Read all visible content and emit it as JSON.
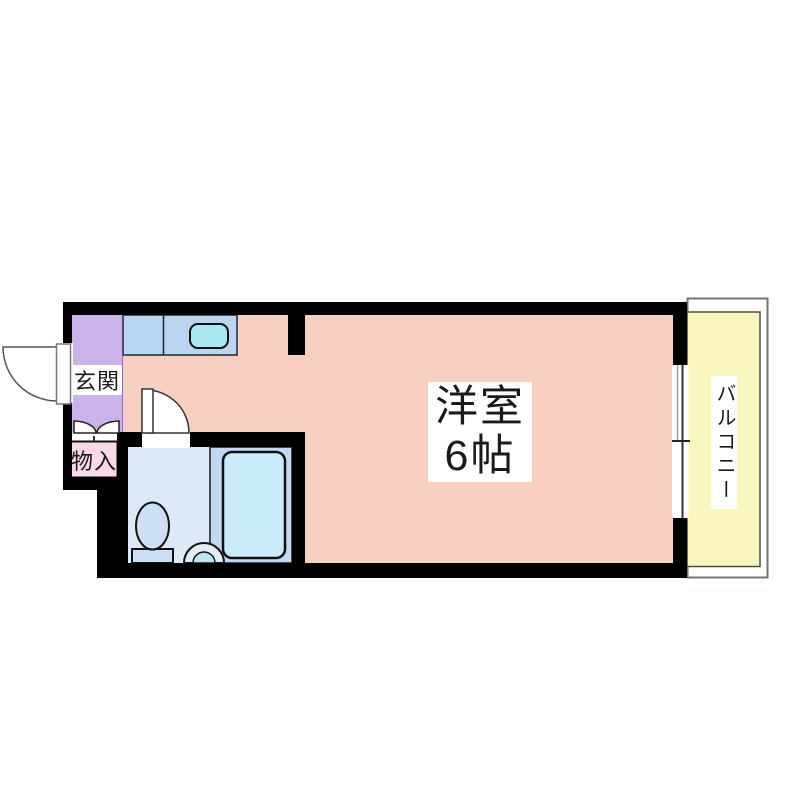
{
  "floor_plan": {
    "labels": {
      "entrance": "玄関",
      "storage": "物入",
      "main_room_line1": "洋室",
      "main_room_line2": "6帖",
      "balcony": "バルコニー"
    },
    "colors": {
      "wall": "#000000",
      "main_room_floor": "#F9CFC1",
      "entrance_floor": "#CBB3E9",
      "storage_box": "#F8D8E9",
      "kitchen_counter": "#B9D5F1",
      "kitchen_sink": "#A9E8F2",
      "bathroom_floor": "#DCE9F7",
      "bath_zone": "#C5D8F2",
      "bathtub": "#C9EBFA",
      "toilet": "#CDDFF5",
      "washbasin_outer": "#E3EDF9",
      "washbasin_inner": "#BFE4F5",
      "balcony_floor": "#FAF6BF",
      "label_background": "#FFFFFF",
      "opening_fill": "#FFFFFF"
    }
  }
}
